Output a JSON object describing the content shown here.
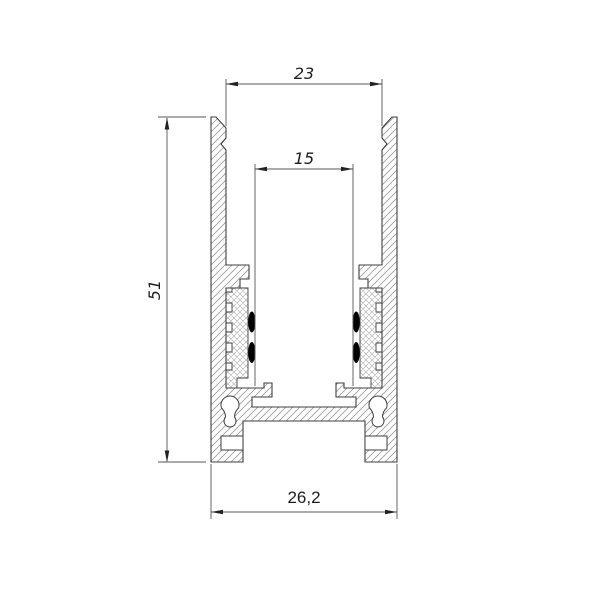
{
  "drawing": {
    "dimensions": {
      "top_width": "23",
      "slot_width": "15",
      "height": "51",
      "bottom_width": "26,2"
    },
    "colors": {
      "background": "#ffffff",
      "outline": "#3f3f3f",
      "dimension_line": "#555555",
      "hatch": "#9a9a9a",
      "crosshatch": "#a5a5a5",
      "gasket_pad": "#000000"
    }
  }
}
